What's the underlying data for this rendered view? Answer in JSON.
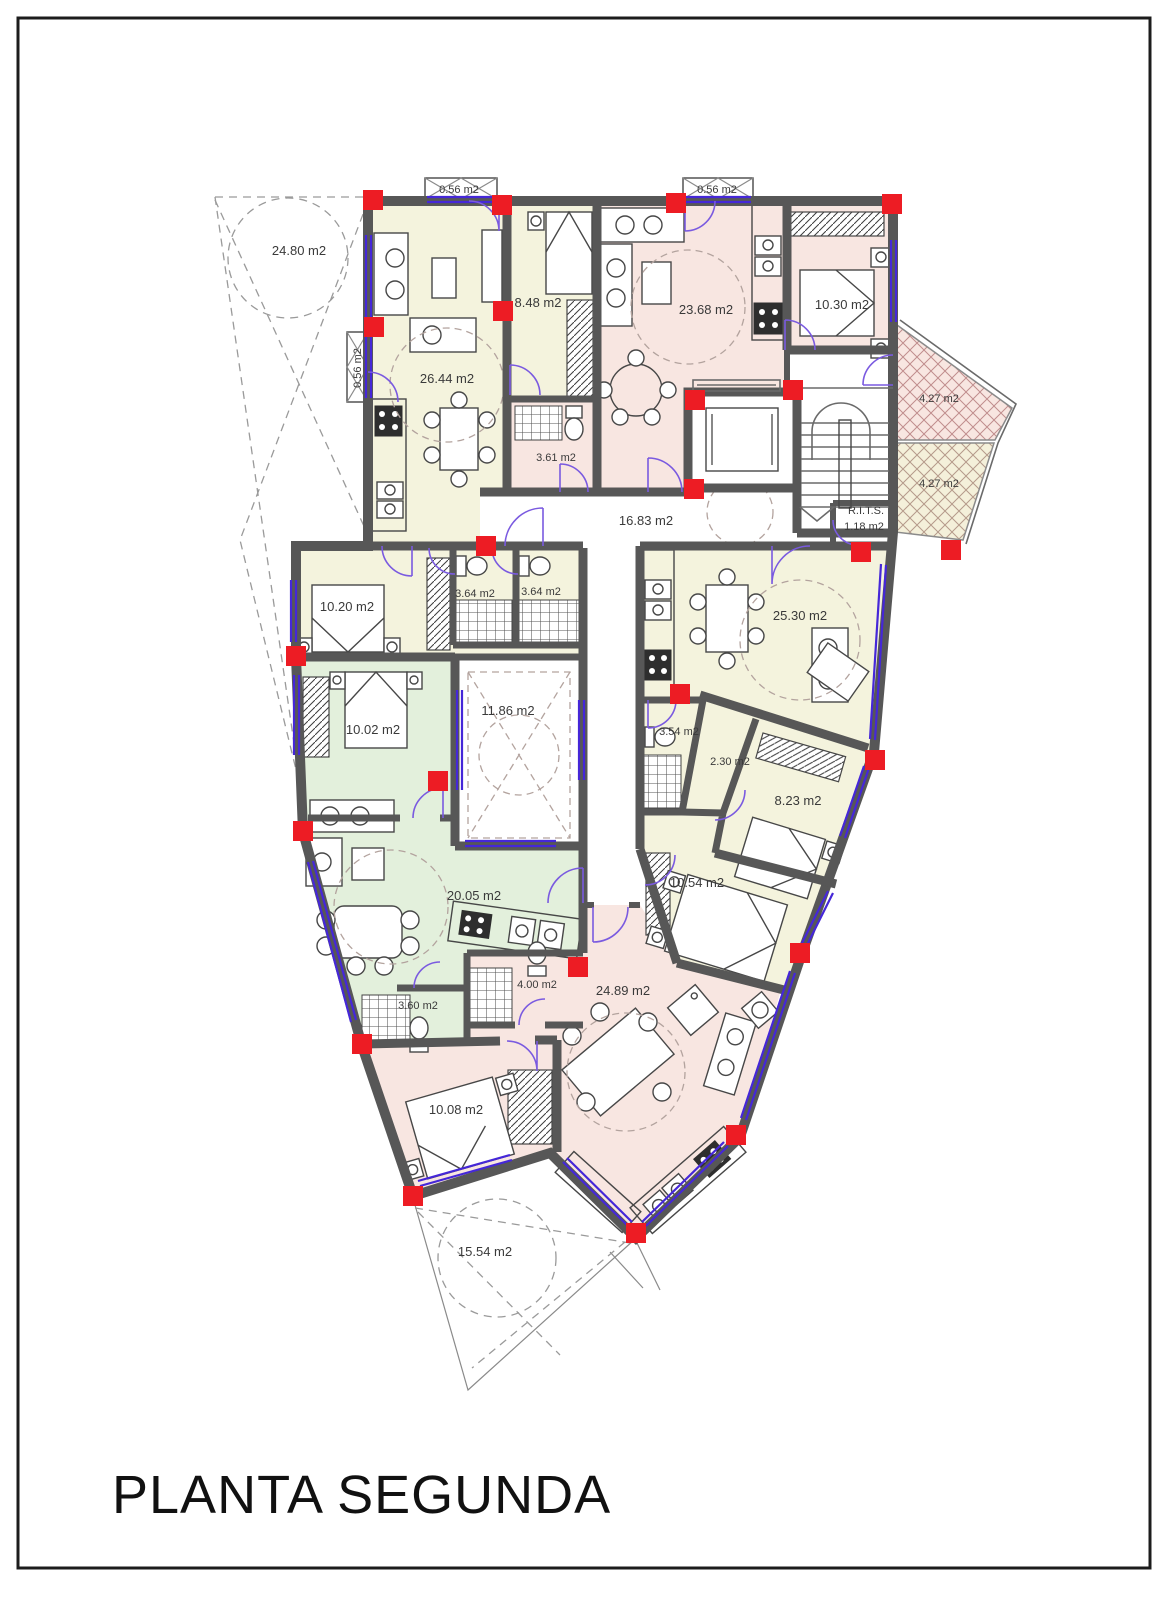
{
  "page": {
    "title": "PLANTA SEGUNDA"
  },
  "plan": {
    "area_labels": {
      "parcel_top": "24.80 m2",
      "balcony_1": "0.56 m2",
      "balcony_2": "0.56 m2",
      "balcony_left": "0.56 m2",
      "room_26_44": "26.44 m2",
      "room_8_48": "8.48 m2",
      "room_23_68": "23.68 m2",
      "room_10_30": "10.30 m2",
      "room_3_61": "3.61 m2",
      "terrace_upper": "4.27 m2",
      "terrace_lower": "4.27 m2",
      "corridor": "16.83 m2",
      "rits_line1": "R.I.T.S.",
      "rits_line2": "1.18 m2",
      "room_10_20": "10.20 m2",
      "bath_3_64_a": "3.64 m2",
      "bath_3_64_b": "3.64 m2",
      "room_25_30": "25.30 m2",
      "room_10_02": "10.02 m2",
      "patio": "11.86 m2",
      "bath_3_54": "3.54 m2",
      "hall_2_30": "2.30 m2",
      "room_8_23": "8.23 m2",
      "room_20_05": "20.05 m2",
      "room_10_54": "10.54 m2",
      "bath_3_60": "3.60 m2",
      "bath_4_00": "4.00 m2",
      "room_24_89": "24.89 m2",
      "room_10_08": "10.08 m2",
      "parcel_bottom": "15.54 m2"
    },
    "colors": {
      "apartment_cream": "#f4f3dd",
      "apartment_pink": "#f8e6e1",
      "apartment_green": "#e3f0dc",
      "wall": "#575757",
      "column_marker": "#ed1c24",
      "window_door": "#4527d8",
      "dashed_guides": "#9a9a9a"
    }
  }
}
